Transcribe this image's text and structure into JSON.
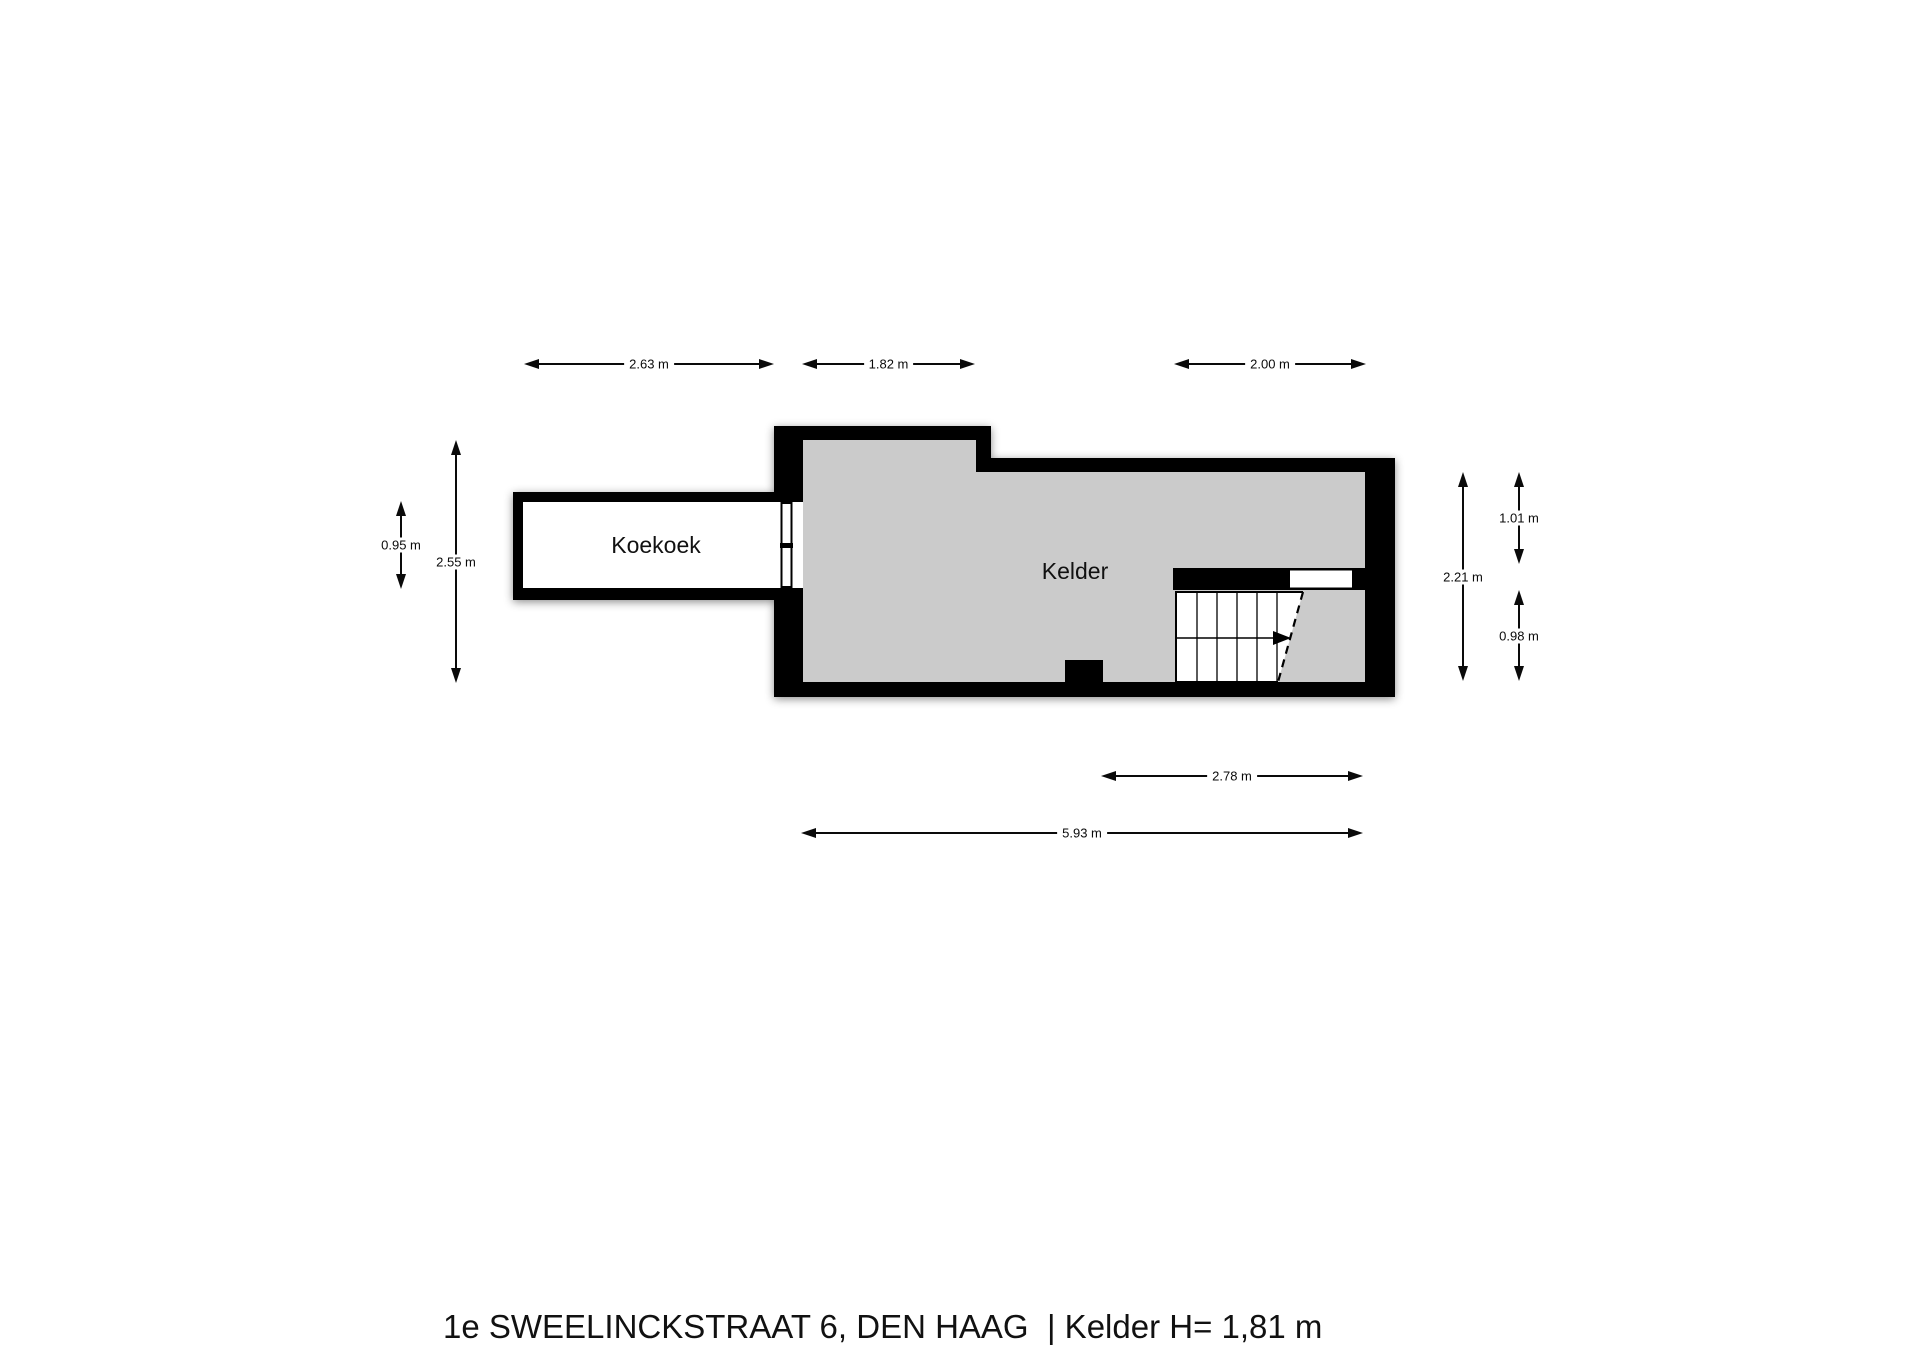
{
  "title": "1e SWEELINCKSTRAAT 6, DEN HAAG  | Kelder H= 1,81 m",
  "rooms": {
    "koekoek": "Koekoek",
    "kelder": "Kelder"
  },
  "dimensions": {
    "top": [
      "2.63 m",
      "1.82 m",
      "2.00 m"
    ],
    "left": [
      "0.95 m",
      "2.55 m"
    ],
    "right": [
      "2.21 m",
      "1.01 m",
      "0.98 m"
    ],
    "bottom": [
      "2.78 m",
      "5.93 m"
    ]
  },
  "colors": {
    "wall": "#000000",
    "floor_fill": "#cbcbcb",
    "background": "#ffffff"
  }
}
